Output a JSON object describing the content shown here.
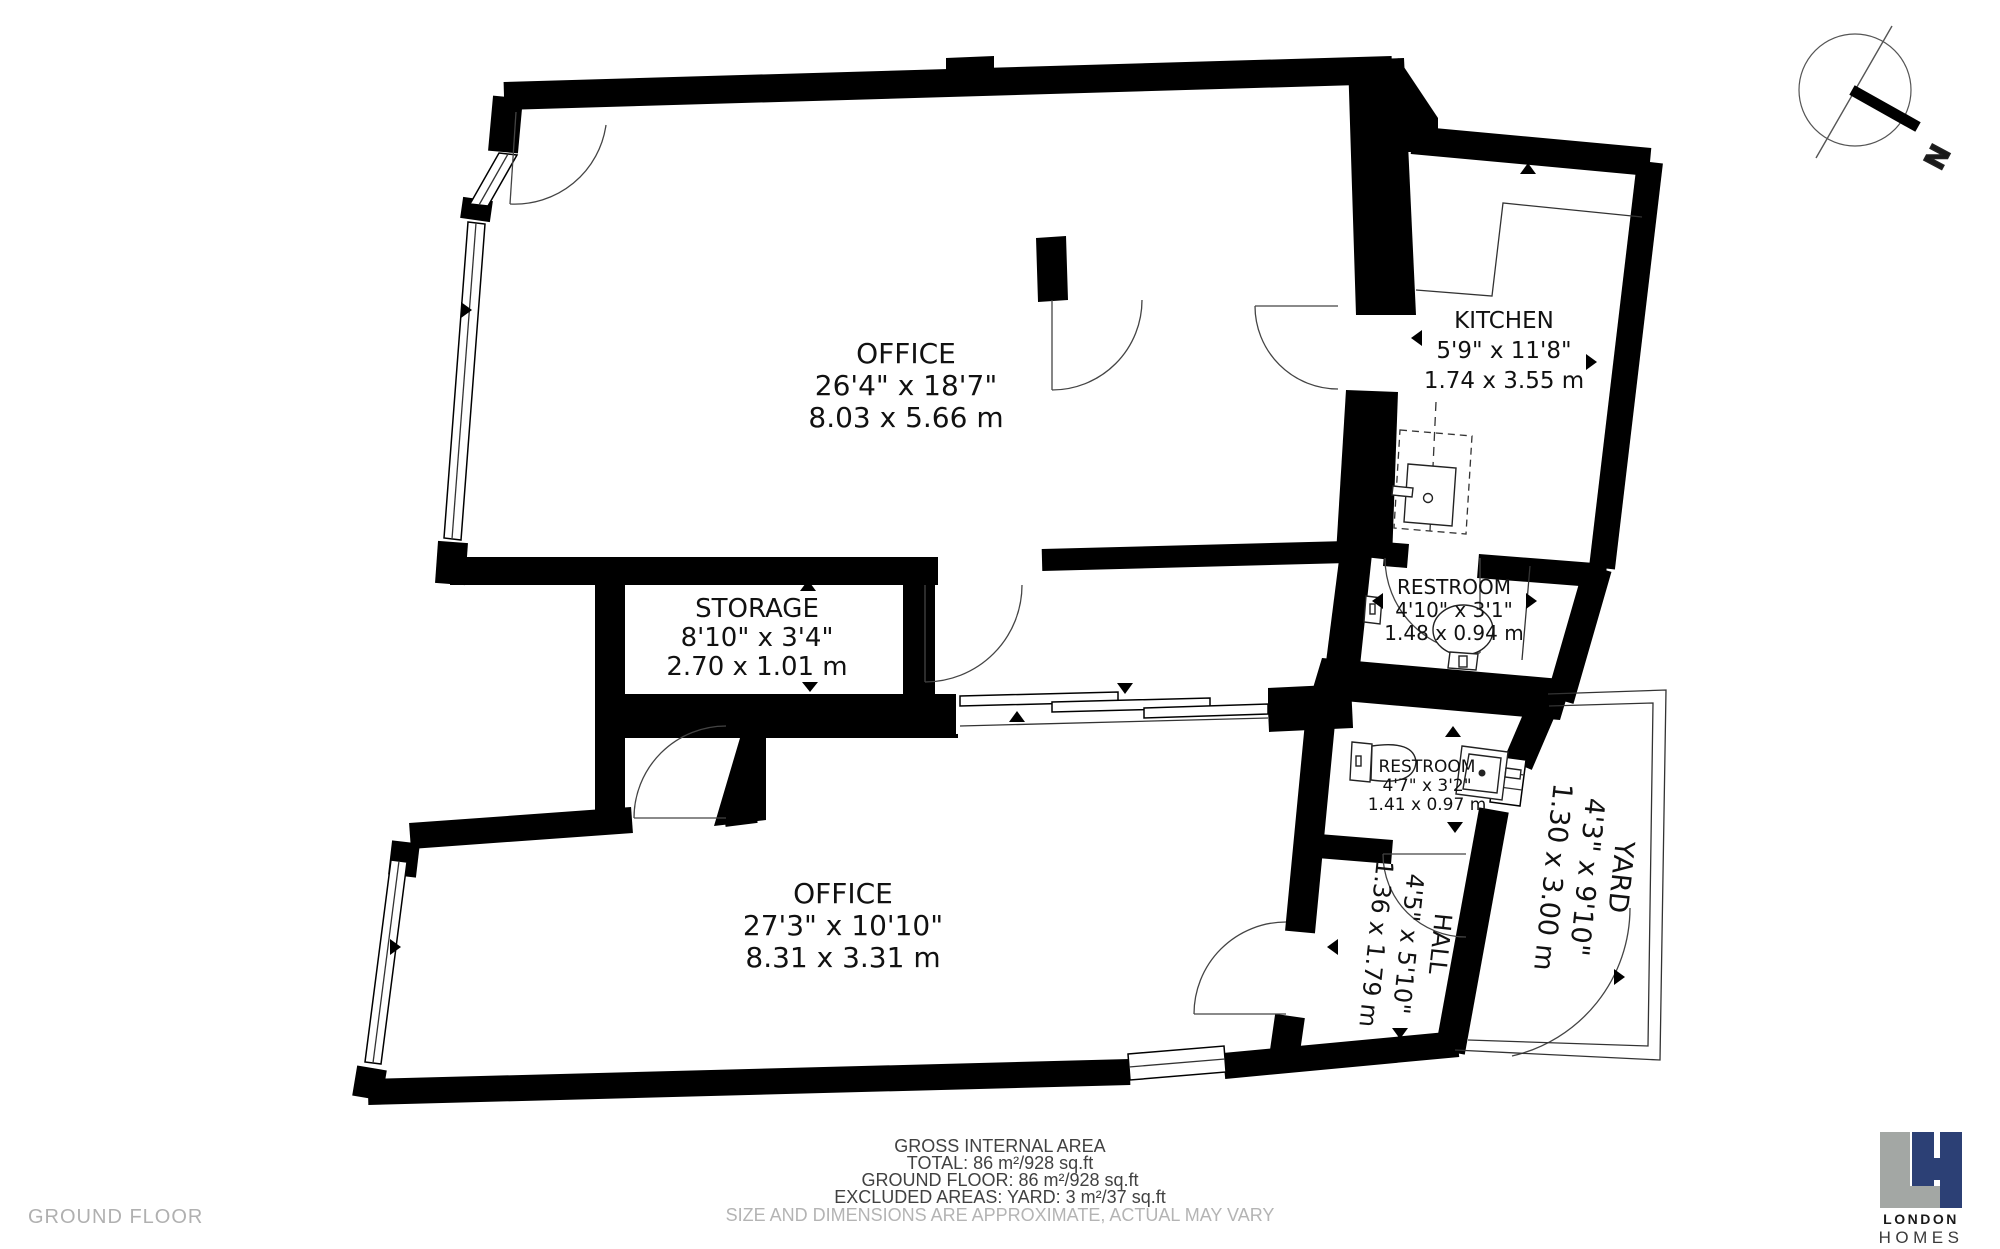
{
  "page": {
    "floor_label": "GROUND FLOOR"
  },
  "compass": {
    "north_label": "N"
  },
  "rooms": [
    {
      "id": "office-top",
      "name": "OFFICE",
      "imperial": "26'4\" x 18'7\"",
      "metric": "8.03 x 5.66 m"
    },
    {
      "id": "kitchen",
      "name": "KITCHEN",
      "imperial": "5'9\" x 11'8\"",
      "metric": "1.74 x 3.55 m"
    },
    {
      "id": "storage",
      "name": "STORAGE",
      "imperial": "8'10\" x 3'4\"",
      "metric": "2.70 x 1.01 m"
    },
    {
      "id": "restroom-upper",
      "name": "RESTROOM",
      "imperial": "4'10\" x 3'1\"",
      "metric": "1.48 x 0.94 m"
    },
    {
      "id": "restroom-lower",
      "name": "RESTROOM",
      "imperial": "4'7\" x 3'2\"",
      "metric": "1.41 x 0.97 m"
    },
    {
      "id": "office-bottom",
      "name": "OFFICE",
      "imperial": "27'3\" x 10'10\"",
      "metric": "8.31 x 3.31 m"
    },
    {
      "id": "hall",
      "name": "HALL",
      "imperial": "4'5\" x 5'10\"",
      "metric": "1.36 x 1.79 m"
    },
    {
      "id": "yard",
      "name": "YARD",
      "imperial": "4'3\" x 9'10\"",
      "metric": "1.30 x 3.00 m"
    }
  ],
  "area_summary": {
    "title": "GROSS INTERNAL AREA",
    "total": "TOTAL: 86 m²/928 sq.ft",
    "ground_floor": "GROUND FLOOR: 86 m²/928 sq.ft",
    "excluded": "EXCLUDED AREAS: YARD: 3 m²/37 sq.ft",
    "disclaimer": "SIZE AND DIMENSIONS ARE APPROXIMATE, ACTUAL MAY VARY"
  },
  "logo": {
    "line1": "LONDON",
    "line2": "HOMES",
    "l_color": "#a3a7a4",
    "h_color": "#2c4075"
  }
}
